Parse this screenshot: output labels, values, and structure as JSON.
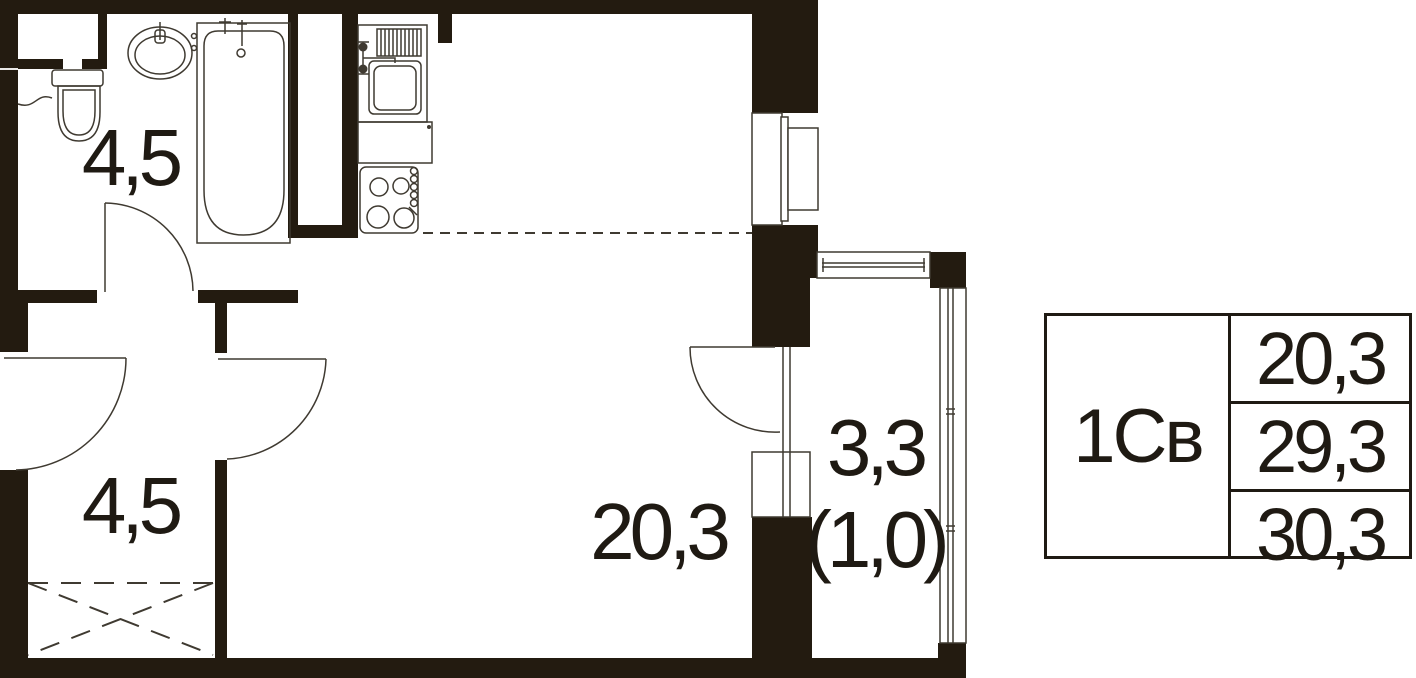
{
  "floorplan": {
    "rooms": [
      {
        "name": "bathroom",
        "area_label": "4,5"
      },
      {
        "name": "hallway",
        "area_label": "4,5"
      },
      {
        "name": "living-room",
        "area_label": "20,3"
      },
      {
        "name": "balcony",
        "area_label": "3,3",
        "area_label_reduced": "(1,0)"
      }
    ],
    "colors": {
      "wall": "#231b10",
      "line": "#3f3a31",
      "text": "#1f1a13",
      "background": "#ffffff"
    }
  },
  "legend": {
    "unit_type": "1Св",
    "rows": [
      "20,3",
      "29,3",
      "30,3"
    ]
  }
}
